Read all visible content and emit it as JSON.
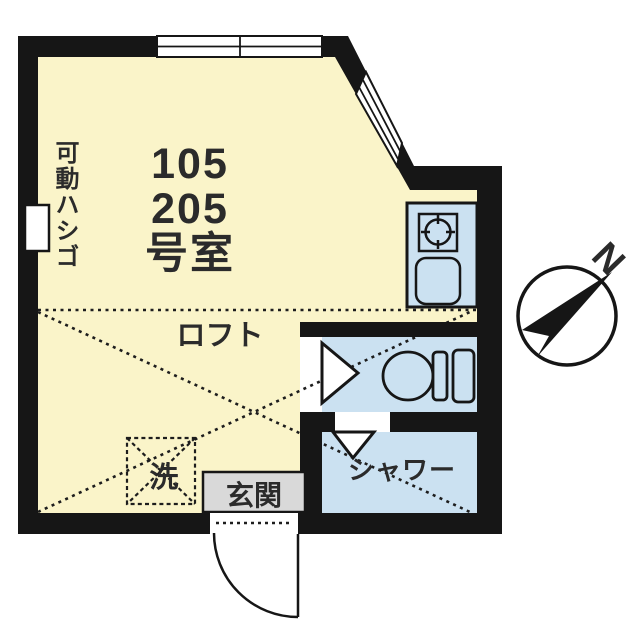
{
  "floorplan": {
    "room_number": {
      "line1": "105",
      "line2": "205",
      "line3": "号室"
    },
    "labels": {
      "ladder": "可動ハシゴ",
      "loft": "ロフト",
      "washer": "洗",
      "entrance": "玄関",
      "shower": "シャワー",
      "compass_north": "N"
    },
    "colors": {
      "wall": "#161616",
      "room_fill": "#FAF4C9",
      "wet_area_fill": "#CBE1F1",
      "entrance_box_fill": "#D9D9D9",
      "text": "#2B2B2B",
      "dash_line": "#1D1D1D"
    }
  }
}
